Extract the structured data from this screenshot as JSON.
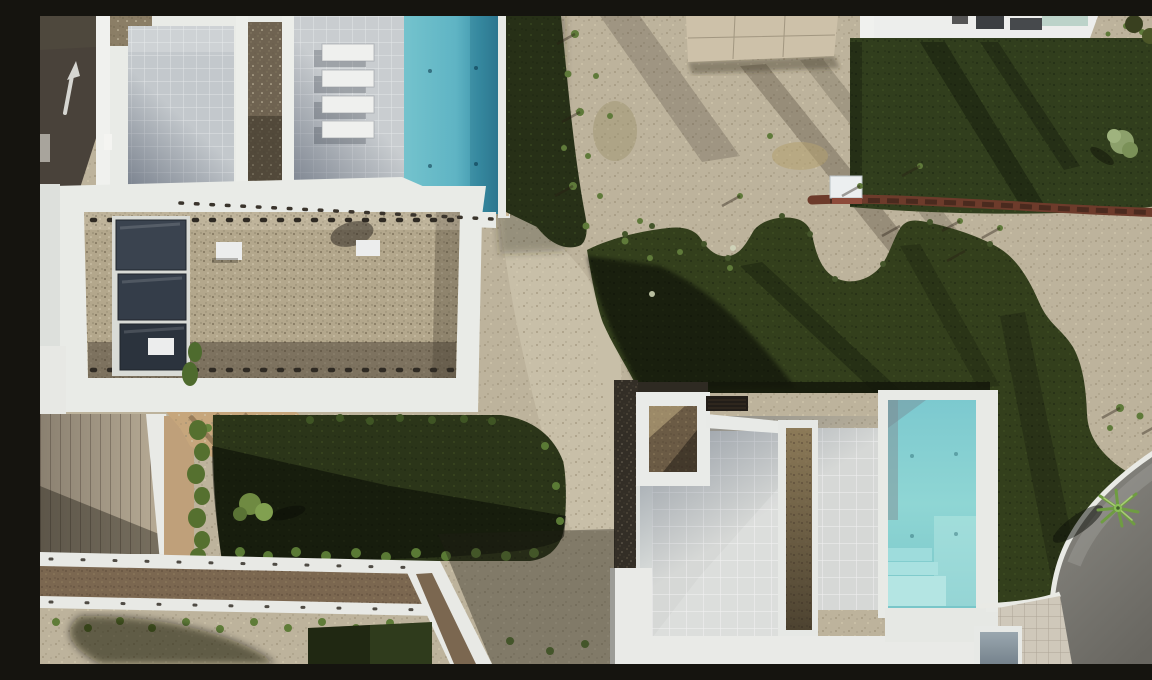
{
  "meta": {
    "description": "Top-down aerial drone photograph of a modern white villa complex: a large flat gravel roof with three dark skylights, two turquoise swimming pools, pale tiled terraces with four white sun loungers, dark green lawns, gravel gardens with shrubs, an asphalt road with a white arrow marking at top left and a curved grey road at bottom right"
  },
  "palette": {
    "asphalt_road": "#49423a",
    "road_arrow": "#d6d6d1",
    "white_wall": "#eaece8",
    "tile_light": "#c9cdd0",
    "tile_shadow": "#97a1ab",
    "pool_top_water": "#5fb4c4",
    "pool_bottom_water": "#8fd6d4",
    "grass_dark": "#2c3718",
    "grass_mid": "#333f1c",
    "gravel_roof": "#b3a78c",
    "scrub_ground": "#bdb39c",
    "brown_gravel": "#7b6750",
    "skylight_glass": "#343d49",
    "red_hedge": "#6d3b2b",
    "tan_pavers": "#c7aa80",
    "grey_road": "#7b7a75",
    "concrete_pad": "#cdc1a9",
    "plank_deck": "#a89d8d",
    "hedge_green": "#5a7a35"
  },
  "objects": {
    "road_top_left": "dark asphalt street with white directional arrow",
    "villa_top_left": "white villa with grey tiled courtyards and gravel planter strips",
    "sun_loungers_count": 4,
    "pool_top": "turquoise lap pool with white rim",
    "gravel_roof_building": "flat roof covered in beige gravel with perimeter fixing dots",
    "skylights_count": 3,
    "roof_vents": "small white vent boxes on gravel roof",
    "concrete_pad": "light concrete slab casting long shadows",
    "lawn_top_right": "dark lawn with small olive tree",
    "red_hedge_row": "row of reddish shrubs between lawn and scrub",
    "ac_unit": "white utility unit with red planting beside lawn",
    "center_lawn": "large wavy-edged lawn with tree shadows",
    "villa_center": "white villa with tiled terrace, gravel courtyard, pergola, planter strip and pool with steps",
    "pool_center": "turquoise pool with corner steps",
    "deck_bottom_left": "timber plank deck beside white wall",
    "lawn_bottom_left": "hedged lawn with small tree",
    "carport_roof_strip": "long white-edged roof filled with brown gravel",
    "palm_tree": "small palm at lawn corner near road",
    "curved_road": "grey asphalt road with white curb, bottom right",
    "blue_grey_roof": "small blue-grey flat roof at bottom corner",
    "pavers": "pale and tan paver areas along the road"
  }
}
